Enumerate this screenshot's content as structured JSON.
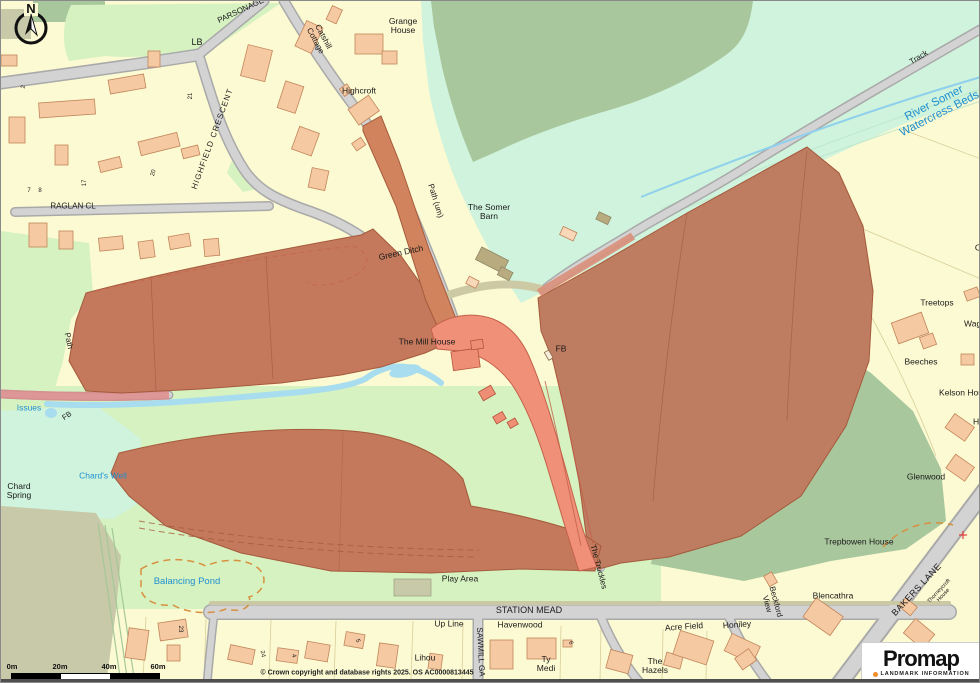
{
  "map": {
    "north_label": "N",
    "copyright": "© Crown copyright and database rights 2025. OS AC0000813445",
    "scale_bar": {
      "labels": [
        "0m",
        "20m",
        "40m",
        "60m"
      ]
    },
    "labels": [
      {
        "t": "PARSONAGE",
        "x": 240,
        "y": 10,
        "r": -25,
        "s": 8
      },
      {
        "t": "LB",
        "x": 196,
        "y": 42,
        "s": 9
      },
      {
        "t": "Catshill\nCottage",
        "x": 318,
        "y": 38,
        "r": 62,
        "s": 8
      },
      {
        "t": "Grange\nHouse",
        "x": 402,
        "y": 25,
        "s": 8.5
      },
      {
        "t": "Highcroft",
        "x": 358,
        "y": 90,
        "s": 8.5
      },
      {
        "t": "HIGHFIELD  CRESCENT",
        "x": 212,
        "y": 138,
        "r": -70,
        "s": 8,
        "sp": 1
      },
      {
        "t": "RAGLAN CL",
        "x": 72,
        "y": 206,
        "s": 8
      },
      {
        "t": "Track",
        "x": 918,
        "y": 57,
        "r": -31,
        "s": 8
      },
      {
        "t": "River Somer\nWatercress Beds",
        "x": 936,
        "y": 108,
        "r": -27,
        "s": 11.5,
        "c": "w"
      },
      {
        "t": "Path (um)",
        "x": 434,
        "y": 200,
        "r": 73,
        "s": 8
      },
      {
        "t": "The Somer\nBarn",
        "x": 488,
        "y": 211,
        "s": 8.5
      },
      {
        "t": "Green Ditch",
        "x": 400,
        "y": 252,
        "r": -12,
        "s": 8.5
      },
      {
        "t": "The Mill House",
        "x": 426,
        "y": 341,
        "s": 8.5
      },
      {
        "t": "FB",
        "x": 560,
        "y": 348,
        "s": 8.5
      },
      {
        "t": "Path",
        "x": 67,
        "y": 340,
        "r": 78,
        "s": 8
      },
      {
        "t": "Issues",
        "x": 28,
        "y": 407,
        "s": 8.5,
        "c": "w"
      },
      {
        "t": "FB",
        "x": 66,
        "y": 415,
        "r": -35,
        "s": 7.5
      },
      {
        "t": "Chard's Well",
        "x": 102,
        "y": 475,
        "s": 8.5,
        "c": "w"
      },
      {
        "t": "Chard\nSpring",
        "x": 18,
        "y": 490,
        "s": 8.5
      },
      {
        "t": "Balancing Pond",
        "x": 186,
        "y": 581,
        "s": 9.5,
        "c": "w"
      },
      {
        "t": "Play Area",
        "x": 459,
        "y": 578,
        "s": 8.5
      },
      {
        "t": "The Truckles",
        "x": 597,
        "y": 566,
        "r": 75,
        "s": 8
      },
      {
        "t": "STATION MEAD",
        "x": 528,
        "y": 610,
        "s": 9
      },
      {
        "t": "Up Line",
        "x": 448,
        "y": 623,
        "s": 8.5
      },
      {
        "t": "Havenwood",
        "x": 519,
        "y": 624,
        "s": 8.5
      },
      {
        "t": "SAWMILL GA",
        "x": 479,
        "y": 651,
        "r": 87,
        "s": 8
      },
      {
        "t": "Lihou",
        "x": 424,
        "y": 657,
        "s": 8.5
      },
      {
        "t": "Ty\nMedi",
        "x": 545,
        "y": 663,
        "s": 8.5
      },
      {
        "t": "The\nHazels",
        "x": 654,
        "y": 665,
        "s": 8.5
      },
      {
        "t": "Acre Field",
        "x": 683,
        "y": 626,
        "r": -4,
        "s": 8.5
      },
      {
        "t": "Honiley",
        "x": 736,
        "y": 624,
        "r": -4,
        "s": 8.5
      },
      {
        "t": "Beckford\nView",
        "x": 770,
        "y": 602,
        "r": 75,
        "s": 8
      },
      {
        "t": "Blencathra",
        "x": 832,
        "y": 595,
        "s": 8.5
      },
      {
        "t": "Trepbowen House",
        "x": 858,
        "y": 541,
        "s": 8.5
      },
      {
        "t": "BAKERS LANE",
        "x": 916,
        "y": 589,
        "r": -47,
        "s": 9,
        "sp": 0.5
      },
      {
        "t": "Thorneycroft\nHouse",
        "x": 941,
        "y": 593,
        "r": -47,
        "s": 5.5
      },
      {
        "t": "Treetops",
        "x": 936,
        "y": 302,
        "s": 8.5
      },
      {
        "t": "Wagg",
        "x": 974,
        "y": 323,
        "s": 8.5
      },
      {
        "t": "Beeches",
        "x": 920,
        "y": 361,
        "s": 8.5
      },
      {
        "t": "Kelson Hou",
        "x": 960,
        "y": 392,
        "s": 8.5
      },
      {
        "t": "Hil",
        "x": 977,
        "y": 421,
        "s": 8.5
      },
      {
        "t": "Glenwood",
        "x": 925,
        "y": 476,
        "s": 8.5
      },
      {
        "t": "C",
        "x": 977,
        "y": 247,
        "s": 8.5
      },
      {
        "t": "21",
        "x": 190,
        "y": 95,
        "r": -90,
        "s": 6
      },
      {
        "t": "20",
        "x": 153,
        "y": 172,
        "r": -75,
        "s": 6
      },
      {
        "t": "17",
        "x": 84,
        "y": 182,
        "r": -90,
        "s": 6
      },
      {
        "t": "7",
        "x": 28,
        "y": 190,
        "s": 6
      },
      {
        "t": "8",
        "x": 39,
        "y": 190,
        "s": 6
      },
      {
        "t": "2",
        "x": 23,
        "y": 86,
        "r": -80,
        "s": 6
      },
      {
        "t": "23",
        "x": 179,
        "y": 628,
        "r": 90,
        "s": 6
      },
      {
        "t": "24",
        "x": 261,
        "y": 653,
        "r": 80,
        "s": 6
      },
      {
        "t": "4",
        "x": 292,
        "y": 655,
        "r": 75,
        "s": 6
      },
      {
        "t": "5",
        "x": 356,
        "y": 640,
        "r": 70,
        "s": 6
      },
      {
        "t": "6",
        "x": 569,
        "y": 642,
        "r": 75,
        "s": 6
      }
    ]
  },
  "logo": {
    "name": "Promap",
    "tagline": "LANDMARK INFORMATION"
  },
  "palette": {
    "background_yellow": "#FCFAD2",
    "mint_green": "#CFF3DC",
    "light_green": "#D6F2C0",
    "sage_green": "#A9C79D",
    "khaki": "#C7C9A9",
    "road_gray": "#D3D3D3",
    "road_casing": "#A9A9A9",
    "building_peach": "#F5C9A2",
    "building_outline": "#C2855A",
    "highlight_red": "#C4795C",
    "highlight_red_bright": "#F09078",
    "highlight_path": "#D0835C",
    "stream_blue": "#A8DCEF",
    "water_label_blue": "#1F8FD0",
    "dashed_orange": "#D89040",
    "promap_orange": "#F28C28"
  }
}
